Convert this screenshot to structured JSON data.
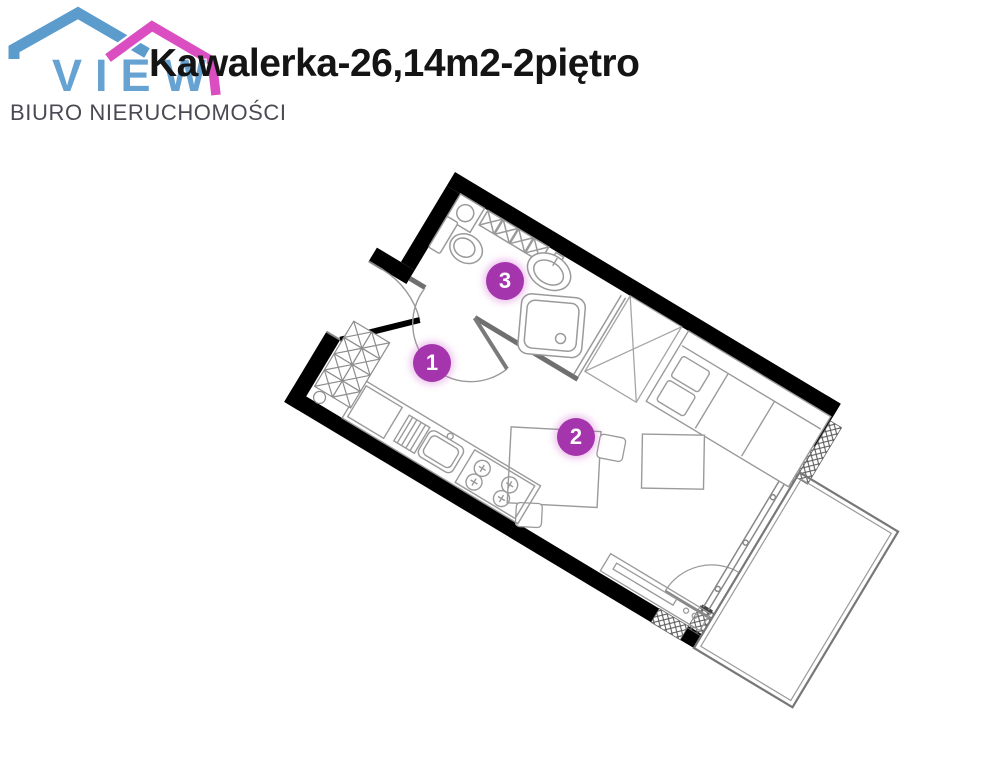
{
  "logo": {
    "brand": "VIEW",
    "subtitle": "BIURO NIERUCHOMOŚCI",
    "roof_blue": "#5C9CCC",
    "roof_pink": "#DB4EC2",
    "text_blue": "#66A3D2",
    "text_gray": "#4A4A52"
  },
  "title": {
    "text": "Kawalerka-26,14m2-2piętro",
    "color": "#141414"
  },
  "floorplan": {
    "marker_color": "#A435AD",
    "markers": [
      {
        "number": "1",
        "label": "hall"
      },
      {
        "number": "2",
        "label": "living-room-with-kitchenette"
      },
      {
        "number": "3",
        "label": "bathroom"
      }
    ],
    "symbols": [
      "entrance-door",
      "bathroom-door",
      "toilet",
      "washbasin",
      "shower",
      "storage-boxes",
      "wardrobe",
      "sofa-bed",
      "ottoman",
      "dining-table",
      "chairs",
      "kitchen-counter",
      "sink",
      "stove",
      "radiator",
      "tv-sideboard",
      "sliding-balcony-door",
      "balcony"
    ]
  }
}
